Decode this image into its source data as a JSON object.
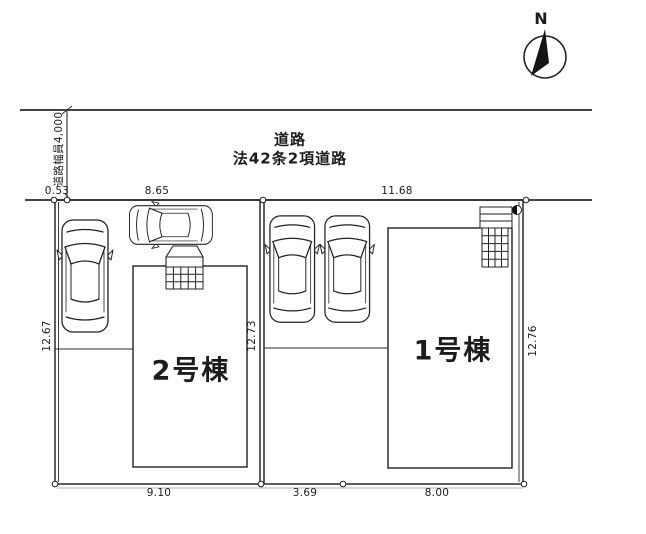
{
  "compass": {
    "north_label": "N"
  },
  "road": {
    "name": "道路",
    "classification": "法42条2項道路",
    "width_note": "道路幅員4,000"
  },
  "buildings": {
    "unit2": {
      "label": "2号棟"
    },
    "unit1": {
      "label": "1号棟"
    }
  },
  "dimensions": {
    "setback": "0.53",
    "frontage_left_lot": "8.65",
    "frontage_right_lot": "11.68",
    "depth_left": "12.67",
    "depth_center": "12.73",
    "depth_right": "12.76",
    "rear_left_lot": "9.10",
    "rear_center": "3.69",
    "rear_right_lot": "8.00"
  },
  "colors": {
    "ink": "#1f1f1f",
    "paper": "#ffffff"
  }
}
